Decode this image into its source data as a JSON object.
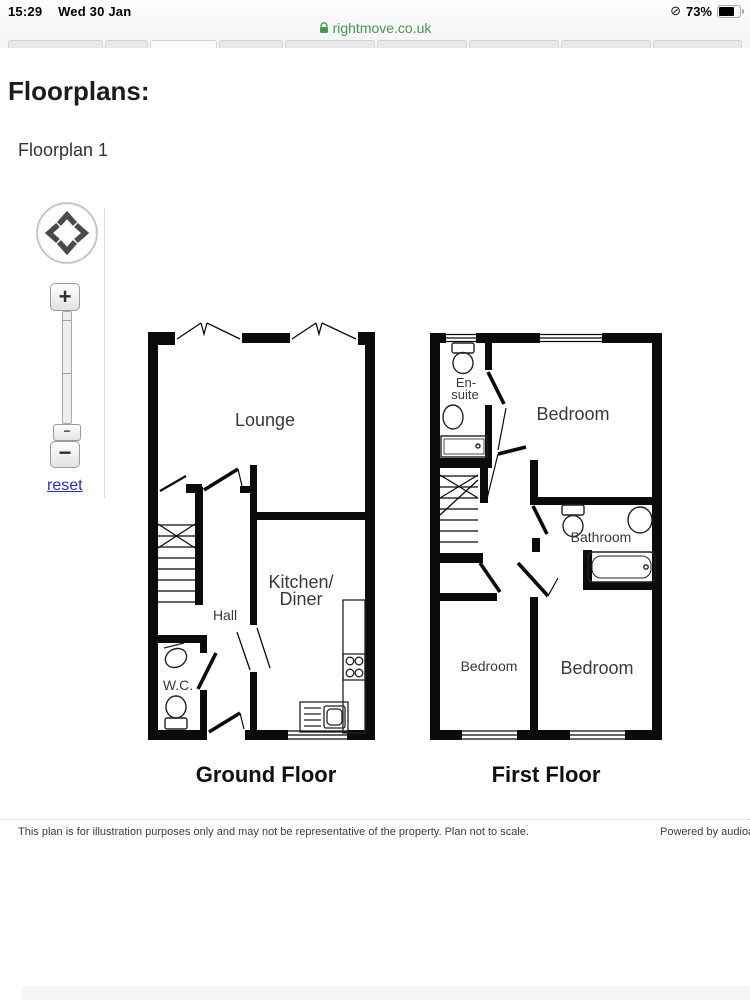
{
  "status_bar": {
    "time": "15:29",
    "date": "Wed 30 Jan",
    "sync_icon": "⊘",
    "battery_percent": "73%"
  },
  "address_bar": {
    "url": "rightmove.co.uk",
    "lock_icon": "green-padlock"
  },
  "page": {
    "heading": "Floorplans:",
    "subheading": "Floorplan 1"
  },
  "zoom_controls": {
    "zoom_in_label": "+",
    "zoom_out_label": "−",
    "handle_label": "−",
    "reset_label": "reset"
  },
  "floorplans": {
    "ground": {
      "caption": "Ground Floor",
      "rooms": {
        "lounge": "Lounge",
        "hall": "Hall",
        "wc": "W.C.",
        "kitchen_line1": "Kitchen/",
        "kitchen_line2": "Diner"
      }
    },
    "first": {
      "caption": "First Floor",
      "rooms": {
        "ensuite_line1": "En-",
        "ensuite_line2": "suite",
        "bedroom_master": "Bedroom",
        "bathroom": "Bathroom",
        "bedroom_left": "Bedroom",
        "bedroom_right": "Bedroom"
      }
    }
  },
  "footer": {
    "disclaimer": "This plan is for illustration purposes only and may not be representative of the property. Plan not to scale.",
    "powered_by": "Powered by audioa"
  },
  "colors": {
    "url_green": "#3f9b4c",
    "link_blue": "#2b2bd0",
    "wall": "#0b0b0b"
  }
}
